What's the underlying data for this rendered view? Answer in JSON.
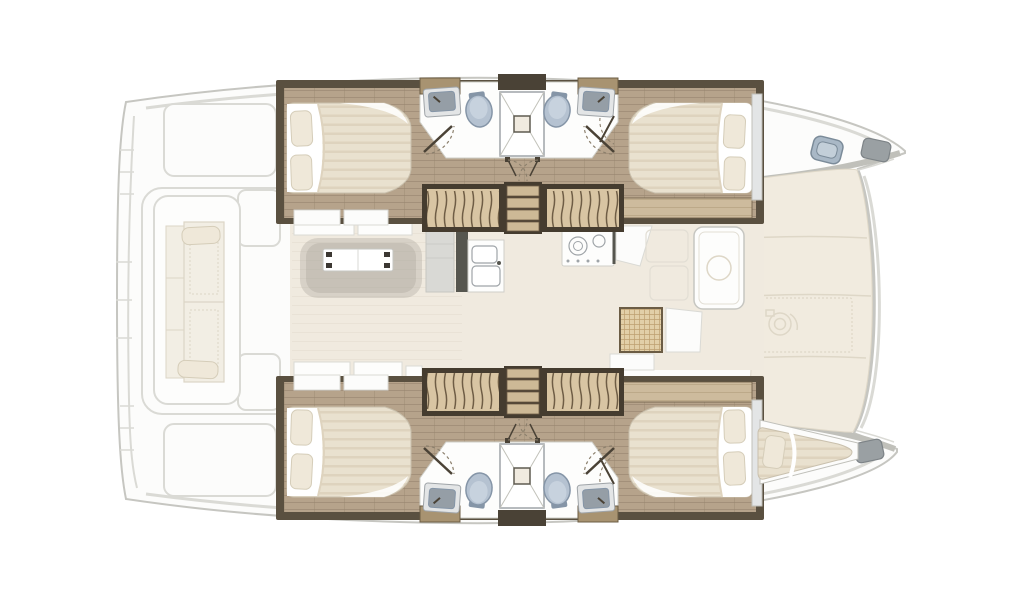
{
  "diagram": {
    "type": "floor-plan",
    "subject": "catamaran-yacht-top-view",
    "orientation": {
      "bow": "right",
      "stern": "left"
    },
    "features": {
      "double_berths": 4,
      "forepeak_berth": 1,
      "toilets": 4,
      "washbasins": 4,
      "showers": 2,
      "stair_flights": 4,
      "stair_landings": 2,
      "saloon_table": 1,
      "galley_double_sink": 1,
      "stove_burners": 2,
      "cockpit_bench": 1,
      "deck_hatch": 1,
      "windlass": 1,
      "door_swings": 6
    },
    "icons": [
      "toilet-icon",
      "washbasin-icon",
      "shower-icon",
      "bed-icon",
      "pillow-icon",
      "stairs-icon",
      "table-icon",
      "stove-icon",
      "galley-sink-icon",
      "deck-hatch-icon",
      "windlass-icon",
      "door-swing-icon",
      "hatch-grid-icon"
    ]
  },
  "colors": {
    "outline": "#c6c6c1",
    "outline_soft": "#dadad5",
    "hull_fill": "#fcfcfb",
    "band_grey": "#c0c0ba",
    "deck_cream": "#f1ebdf",
    "deck_seam": "#ded7c7",
    "wall_dark": "#5a5040",
    "stair_frame": "#453c2f",
    "wood_base": "#b6a38b",
    "wood_stripe": "#a3907a",
    "wood_joint": "#95826c",
    "wood_light": "#cdbb9d",
    "wood_light_stripe": "#bca989",
    "header_tan": "#a89371",
    "trim_brown": "#6b5c44",
    "stair_tread": "#d8c5a3",
    "stair_line": "#6e5d45",
    "plank": "#cdb996",
    "mattress_base": "#e9e1cf",
    "mattress_stripe": "#ded3be",
    "mattress_edge": "#c9c0ad",
    "sheet_white": "#ffffff",
    "pillow": "#efe8d9",
    "pillow_edge": "#d5cdb9",
    "fixture_white": "#fdfdfc",
    "fixture_edge": "#cfcfc9",
    "shower_line": "#c2c2ba",
    "shower_drain_edge": "#5f5b50",
    "toilet": "#b5c2d1",
    "toilet_edge": "#8595a7",
    "toilet_light": "#c7d2de",
    "sink_steel": "#959ea6",
    "sink_frame": "#e3e5e6",
    "sink_edge": "#9fa4a8",
    "door_line": "#4a4236",
    "arc_dash": "#8b7f6c",
    "salon_floor": "#f0eadf",
    "salon_seam": "#e4ddd0",
    "rug": "#aaa49b",
    "dark_accent": "#3c3833",
    "steel_grey": "#d9d9d5",
    "steel_dark": "#56564f",
    "grid_tan": "#e2cfa8",
    "grid_line": "#bd9f70",
    "hatch_blue": "#a9b8c6",
    "hatch_blue_light": "#c3cfd9",
    "hatch_blue_edge": "#7b8b99",
    "bow_roller": "#9aa0a3",
    "bow_roller_edge": "#7d8387",
    "panel_faint": "#e2ded4",
    "cushion": "#f2eee4",
    "cushion_edge": "#dcd5c6"
  }
}
